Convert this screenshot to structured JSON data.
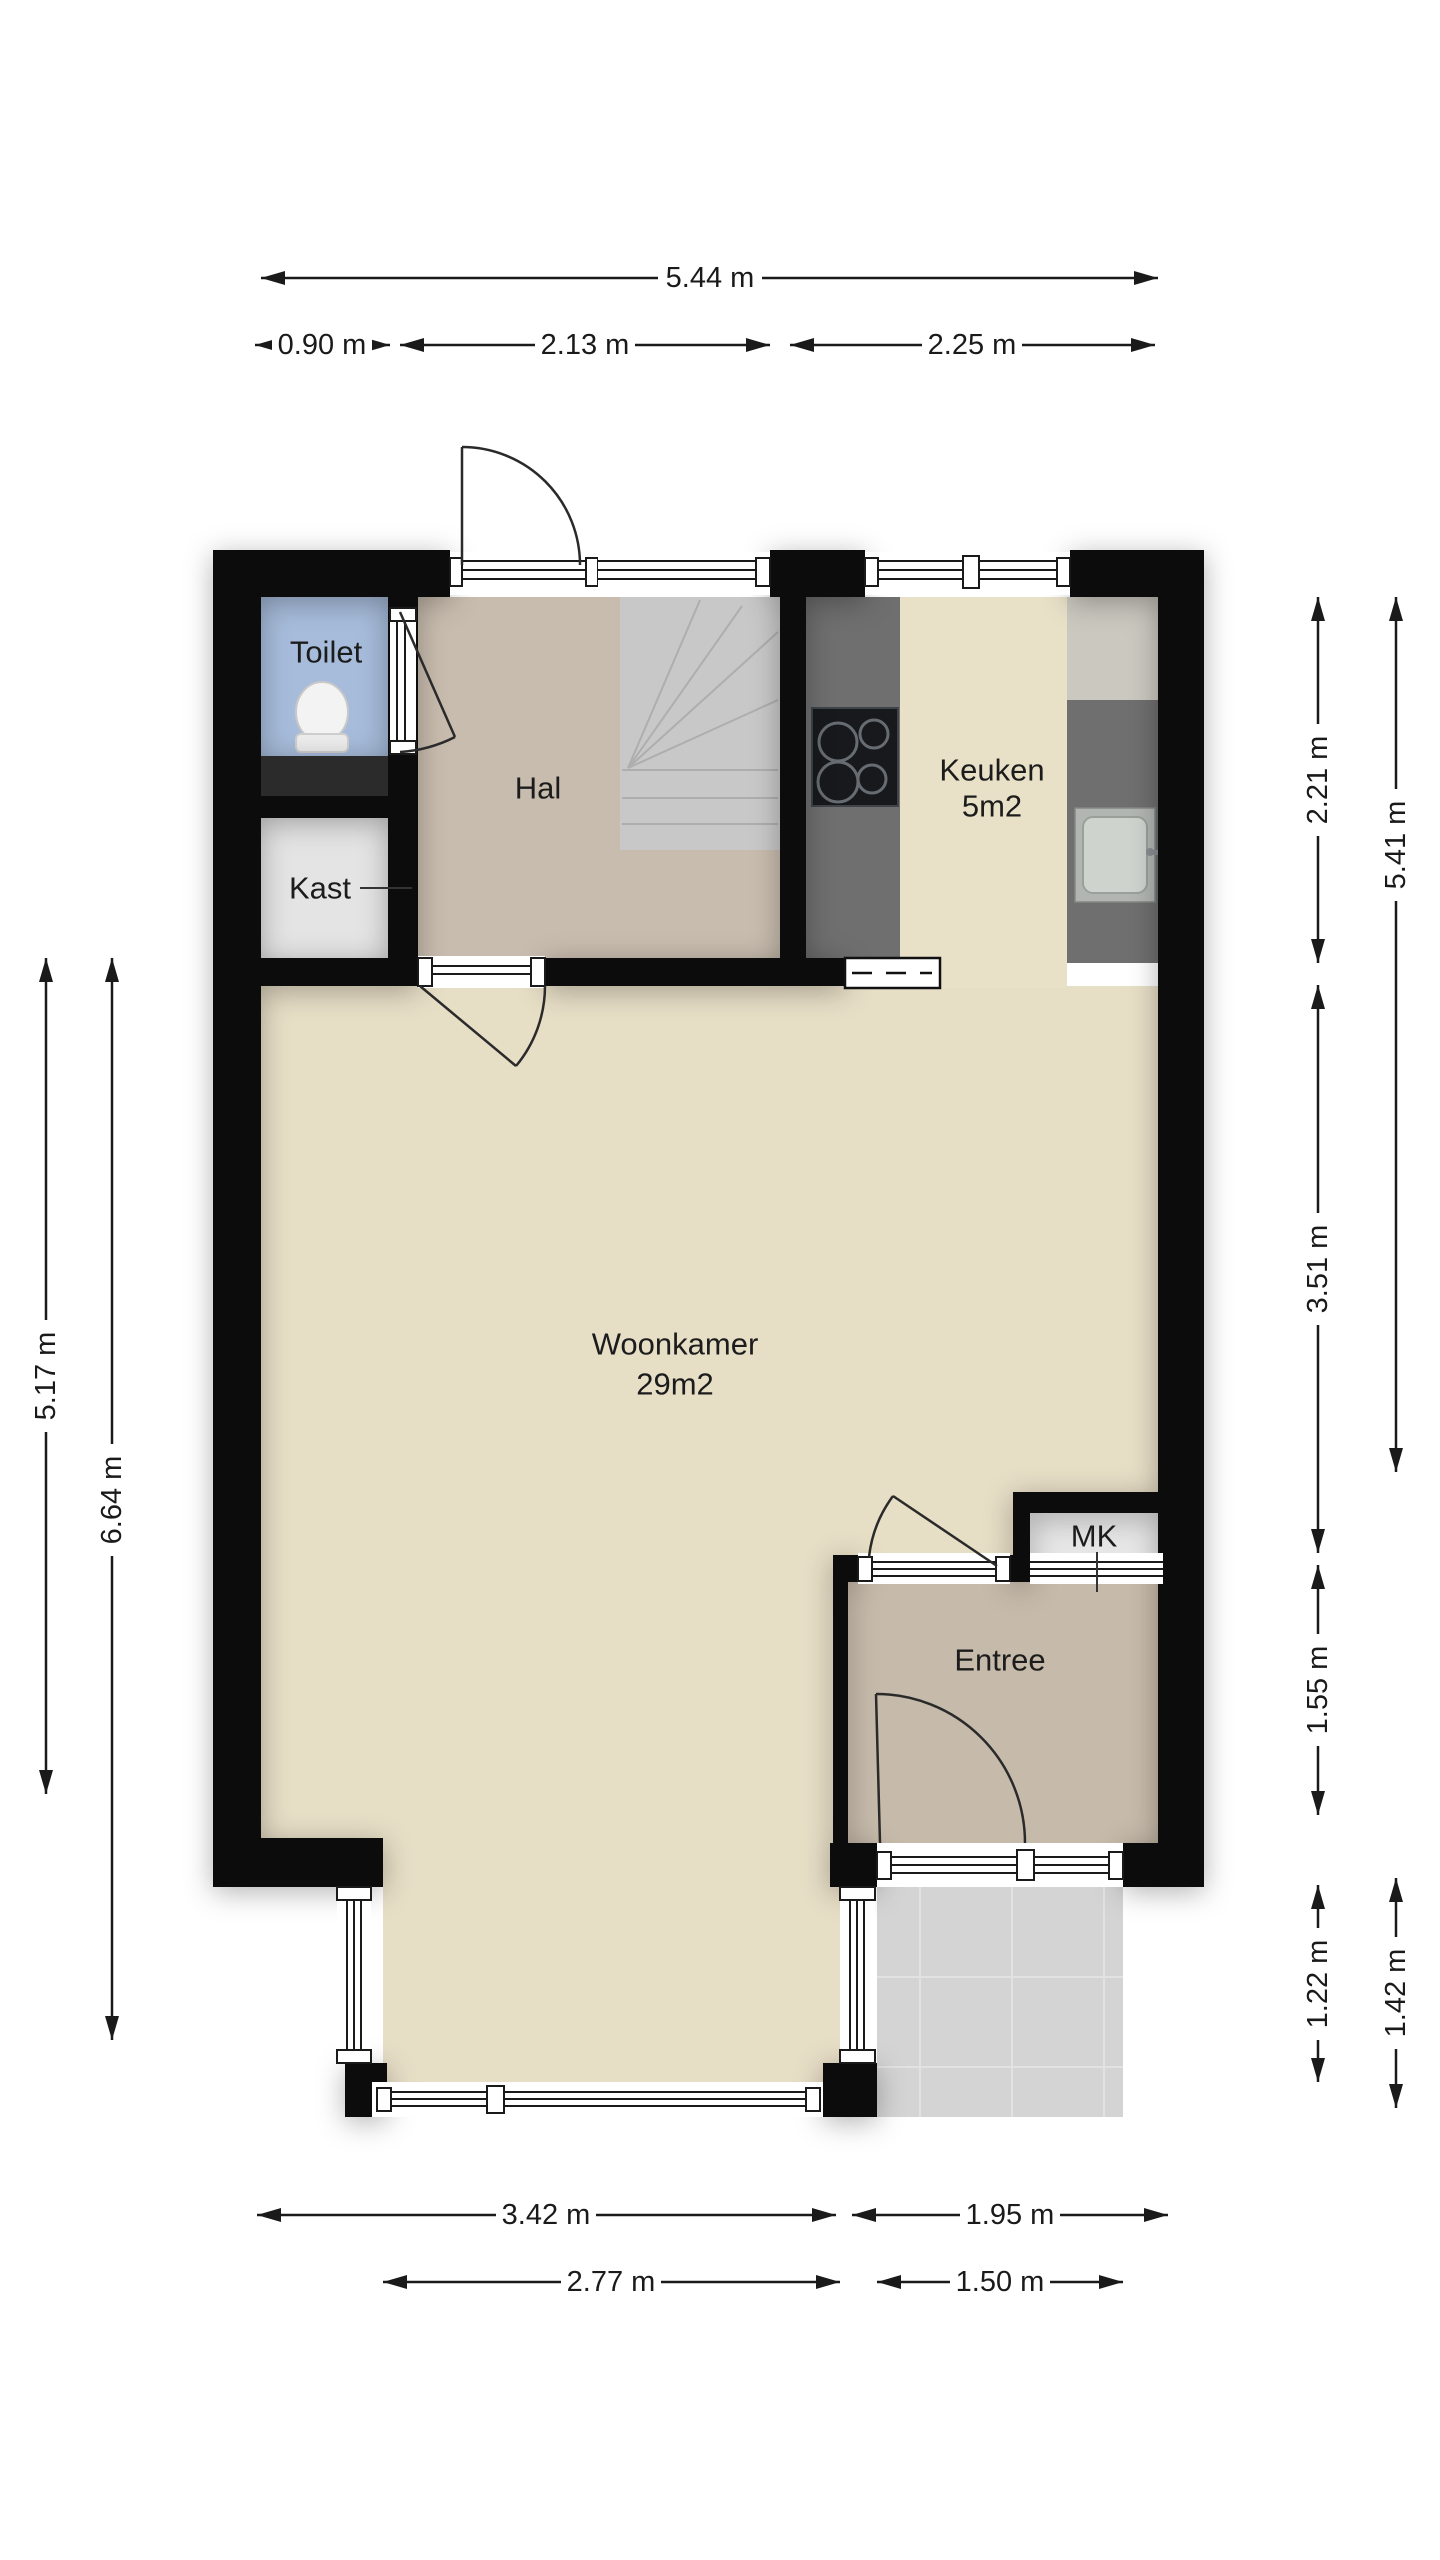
{
  "page": {
    "background": "#ffffff",
    "type": "floorplan"
  },
  "colors": {
    "wall": "#0c0c0c",
    "woonkamer_floor": "#e7dec6",
    "keuken_floor": "#e9e0c8",
    "hal_floor": "#c8bcae",
    "entree_floor": "#c6baaa",
    "toilet_floor": "#a7bcdb",
    "kast_floor": "#e4e4e4",
    "mk_floor": "#e6e6e6",
    "patio_tile": "#d4d4d4",
    "stairs": "#c8c8c8",
    "counter": "#6f6f6f",
    "dimension_text": "#1a1a1a"
  },
  "rooms": {
    "toilet": {
      "label": "Toilet"
    },
    "hal": {
      "label": "Hal"
    },
    "kast": {
      "label": "Kast"
    },
    "keuken": {
      "label": "Keuken",
      "area": "5m2"
    },
    "woonkamer": {
      "label": "Woonkamer",
      "area": "29m2"
    },
    "mk": {
      "label": "MK"
    },
    "entree": {
      "label": "Entree"
    }
  },
  "dimensions": {
    "top": [
      {
        "label": "5.44 m"
      },
      {
        "label": "0.90 m"
      },
      {
        "label": "2.13 m"
      },
      {
        "label": "2.25 m"
      }
    ],
    "left": [
      {
        "label": "5.17 m"
      },
      {
        "label": "6.64 m"
      }
    ],
    "right": [
      {
        "label": "2.21 m"
      },
      {
        "label": "5.41 m"
      },
      {
        "label": "3.51 m"
      },
      {
        "label": "1.55 m"
      },
      {
        "label": "1.22 m"
      },
      {
        "label": "1.42 m"
      }
    ],
    "bottom": [
      {
        "label": "3.42 m"
      },
      {
        "label": "1.95 m"
      },
      {
        "label": "2.77 m"
      },
      {
        "label": "1.50 m"
      }
    ]
  }
}
